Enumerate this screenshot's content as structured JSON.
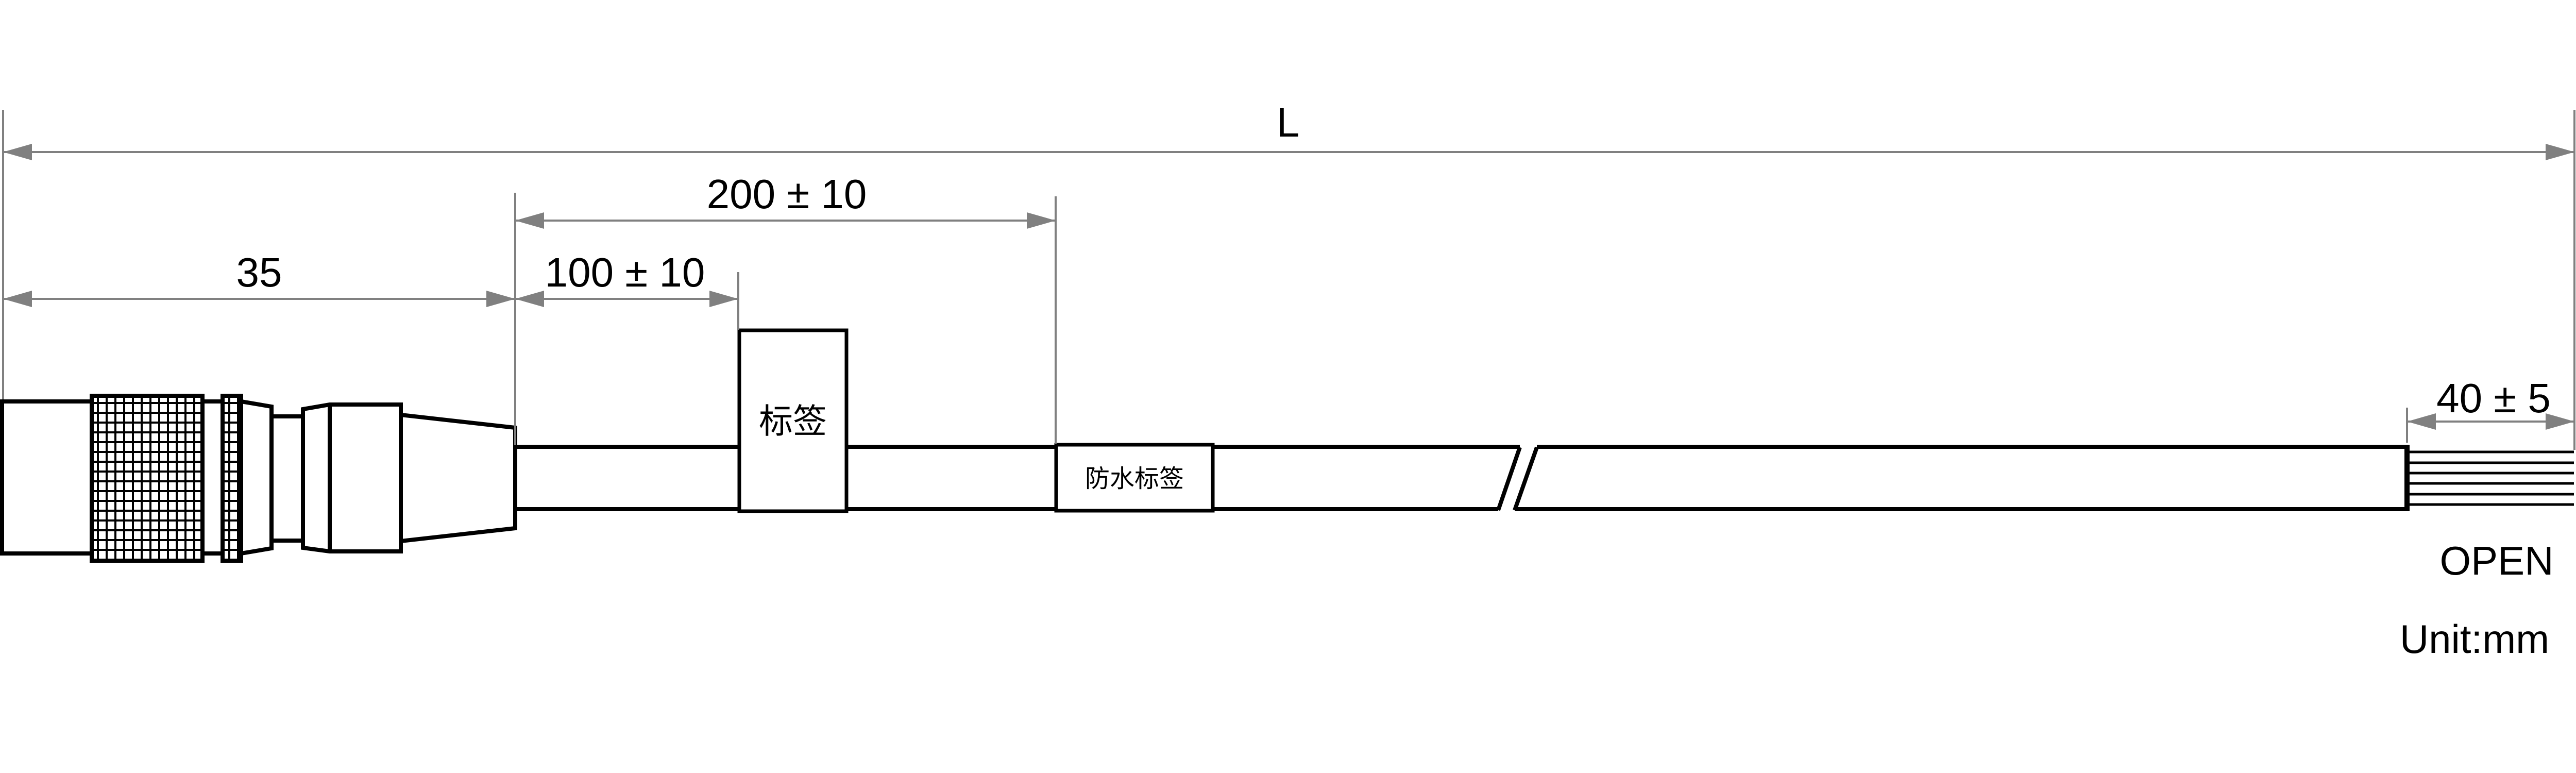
{
  "meta": {
    "background_color": "#ffffff",
    "outline_color": "#000000",
    "dimension_color": "#808080",
    "text_color": "#000000"
  },
  "dimensions": {
    "overall_length": "L",
    "waterproof_offset": "200 ± 10",
    "label_offset": "100 ± 10",
    "connector_length": "35",
    "strip_length": "40 ± 5"
  },
  "labels": {
    "tag": "标签",
    "waterproof_tag": "防水标签",
    "cable_end": "OPEN",
    "unit": "Unit:mm"
  }
}
